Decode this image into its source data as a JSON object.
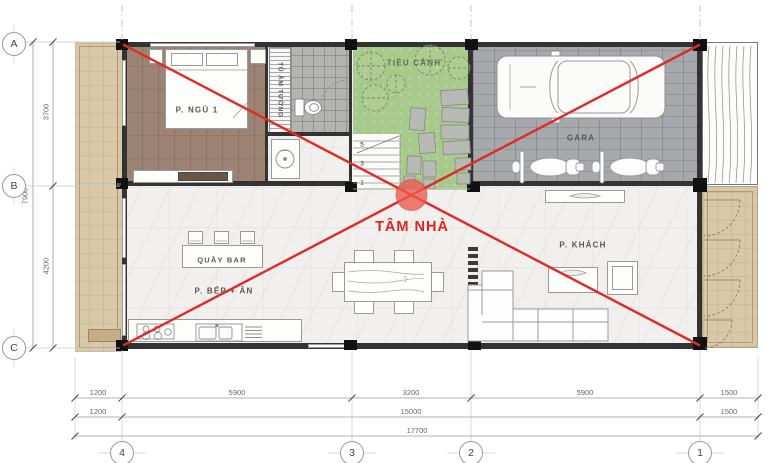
{
  "plan": {
    "center_label": "TÂM NHÀ",
    "rooms": {
      "bedroom": "P. NGỦ 1",
      "wardrobe": "TỦ ÂM TƯỜNG",
      "garden": "TIỂU CẢNH",
      "garage": "GARA",
      "bar": "QUẦY BAR",
      "kitchen_dining": "P. BẾP + ĂN",
      "living": "P. KHÁCH"
    },
    "stairs": [
      "5",
      "3",
      "1"
    ]
  },
  "grid": {
    "rows": [
      "A",
      "B",
      "C"
    ],
    "cols": [
      "4",
      "3",
      "2",
      "1"
    ]
  },
  "dims": {
    "left_total": "7900",
    "left_top": "3700",
    "left_bottom": "4200",
    "row1": [
      "1200",
      "5900",
      "3200",
      "5900",
      "1500"
    ],
    "row2": [
      "1200",
      "15000",
      "1500"
    ],
    "total": "17700"
  },
  "colors": {
    "accent_red": "#e02b24",
    "garden_green": "#a8c98c",
    "planter_tan": "#d9c8a7"
  }
}
